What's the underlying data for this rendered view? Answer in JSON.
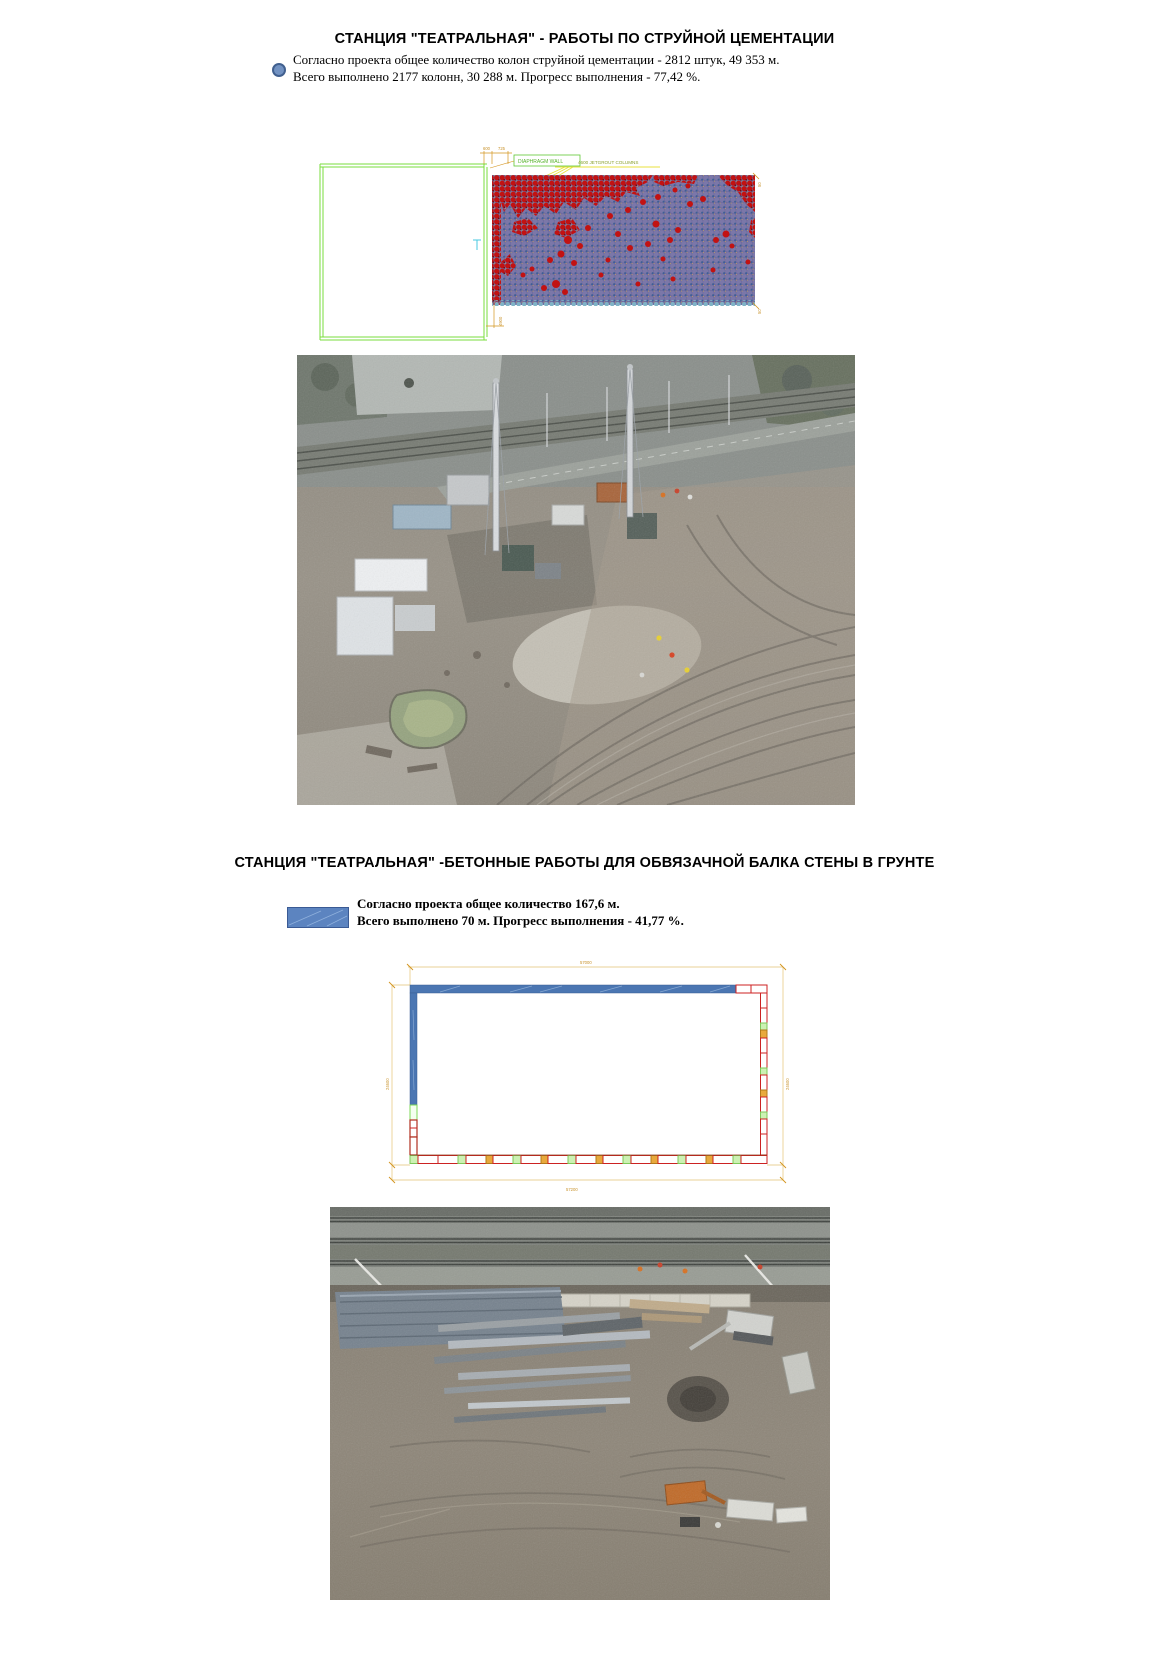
{
  "section1": {
    "title": "СТАНЦИЯ \"ТЕАТРАЛЬНАЯ\" - РАБОТЫ ПО СТРУЙНОЙ ЦЕМЕНТАЦИИ",
    "line1": "Согласно проекта общее количество колон струйной цементации - 2812 штук, 49 353 м.",
    "line2": "Всего выполнено 2177 колонн, 30 288 м. Прогресс выполнения - 77,42 %.",
    "bullet_color": "#7292c2",
    "diagram": {
      "dim_a": "600",
      "dim_b": "725",
      "wall_label": "DIAPHRAGM WALL",
      "columns_label": "4600 JETGROUT COLUMNS",
      "dim_left_bottom": "4900",
      "dim_right_top": "50",
      "dim_right_bottom": "50",
      "colors": {
        "done_dot": "#7b77a8",
        "done_dot_dark": "#3d6095",
        "remaining_dot": "#c21212",
        "remaining_dot_dark": "#7c0a0a",
        "edge_dot": "#7fb3c6",
        "outline_green": "#7ade3c",
        "dim_orange": "#d4951f",
        "leader_yellow": "#e8e23c"
      }
    }
  },
  "section2": {
    "title": "СТАНЦИЯ \"ТЕАТРАЛЬНАЯ\" -БЕТОННЫЕ РАБОТЫ ДЛЯ ОБВЯЗАЧНОЙ БАЛКА СТЕНЫ В ГРУНТЕ",
    "line1": "Согласно проекта общее количество 167,6 м.",
    "line2": "Всего выполнено 70 м. Прогресс выполнения - 41,77 %.",
    "legend_color": "#5c84c0",
    "diagram": {
      "dim_top": "57000",
      "dim_bottom": "57200",
      "dim_left": "24600",
      "dim_right": "24600",
      "done_color": "#4b76b2",
      "pending_color": "#cc2222",
      "joint_green": "#ccf2b3",
      "marker_orange": "#e8a93c"
    }
  }
}
